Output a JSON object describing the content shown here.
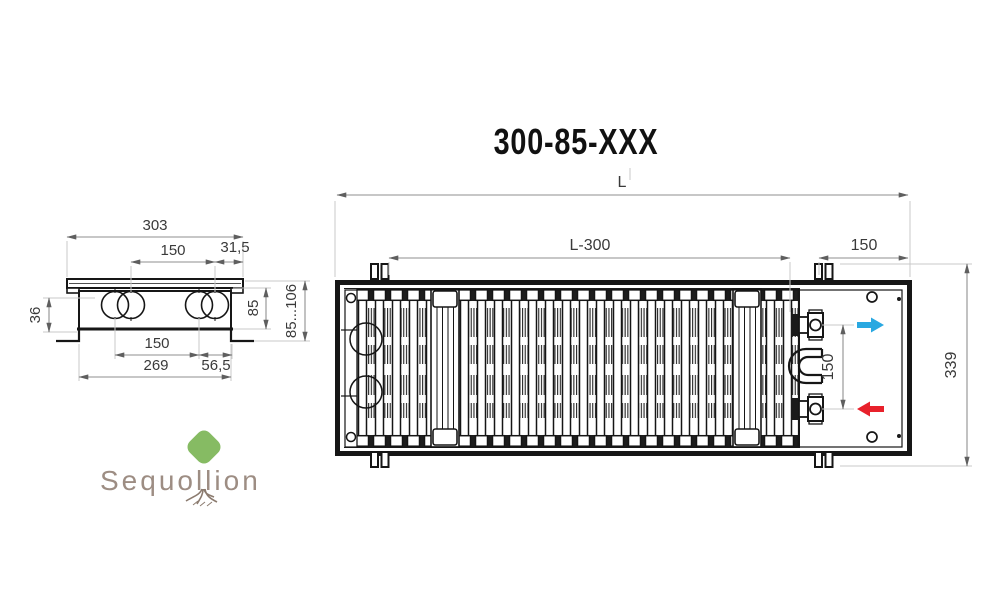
{
  "title": "300-85-XXX",
  "logo": {
    "brand": "Sequollion"
  },
  "side_view": {
    "description": "end cross-section of in-floor convector",
    "dims": {
      "top_width": "303",
      "pipe_spacing_top": "150",
      "edge_offset": "31,5",
      "underfloor_depth": "36",
      "body_height": "85",
      "height_range": "85...106",
      "pipe_spacing_bottom": "150",
      "side_offset": "56,5",
      "body_width": "269"
    }
  },
  "top_view": {
    "description": "plan view of convector with roll-up grille",
    "dims": {
      "length": "L",
      "length_minus_300": "L-300",
      "end_zone": "150",
      "overall_width": "339",
      "connection_spacing": "150"
    }
  },
  "colors": {
    "supply_arrow": "#29a8e1",
    "return_arrow": "#e8212b",
    "outline": "#161616",
    "dimension": "#8f8f8f",
    "extension": "#c9c9c9",
    "logo_text": "#9d8d83",
    "canopy_green": "#8fc26f"
  }
}
